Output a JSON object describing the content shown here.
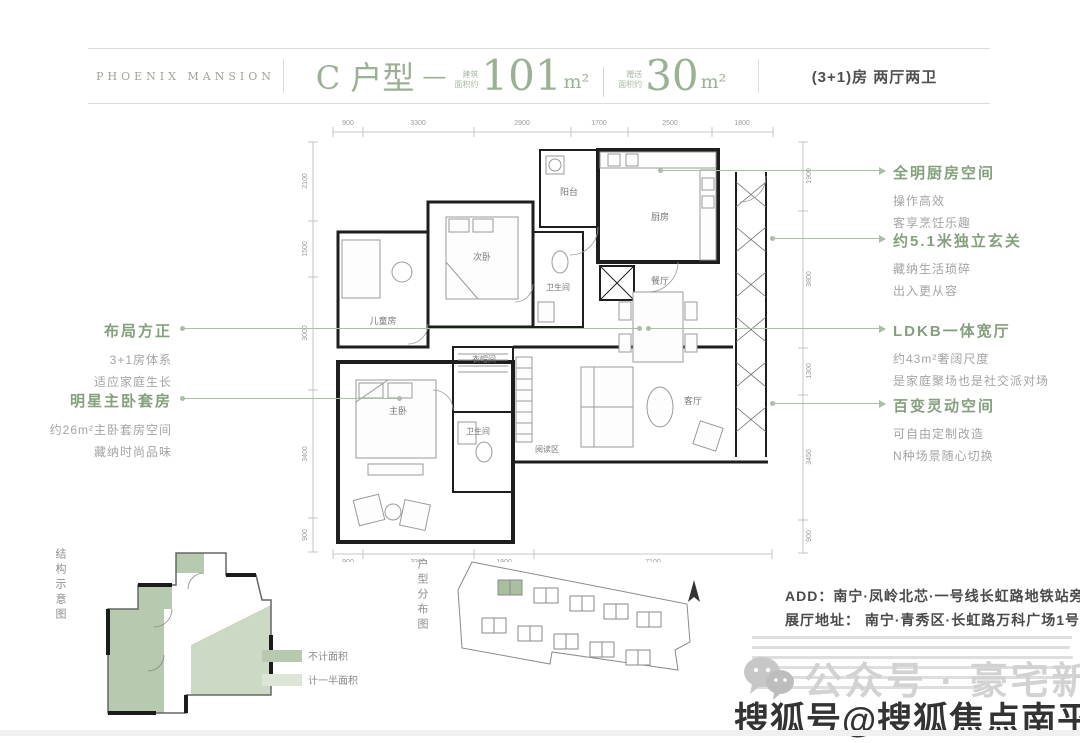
{
  "header": {
    "brand": "PHOENIX MANSION",
    "unit_name": "C 户型",
    "separator": "—",
    "areas": [
      {
        "label_line1": "建筑",
        "label_line2": "面积约",
        "value": "101",
        "unit": "m²"
      },
      {
        "label_line1": "赠送",
        "label_line2": "面积约",
        "value": "30",
        "unit": "m²"
      }
    ],
    "spec": "(3+1)房 两厅两卫"
  },
  "plan": {
    "dims_top": [
      "900",
      "3300",
      "2900",
      "1700",
      "2500",
      "1800"
    ],
    "dims_left": [
      "2100",
      "1500",
      "3000",
      "3400",
      "900"
    ],
    "dims_right": [
      "1900",
      "3800",
      "1300",
      "3450",
      "900"
    ],
    "dims_bottom": [
      "900",
      "3300",
      "1800",
      "7100"
    ],
    "rooms": {
      "balcony": "阳台",
      "kitchen": "厨房",
      "dining": "餐厅",
      "second_bedroom": "次卧",
      "bath1": "卫生间",
      "children": "儿童房",
      "master": "主卧",
      "cloakroom": "衣帽间",
      "bath2": "卫生间",
      "reading": "阅读区",
      "living": "客厅"
    }
  },
  "callouts_left": [
    {
      "title": "布局方正",
      "line1": "3+1房体系",
      "line2": "适应家庭生长"
    },
    {
      "title": "明星主卧套房",
      "line1": "约26m²主卧套房空间",
      "line2": "藏纳时尚品味"
    }
  ],
  "callouts_right": [
    {
      "title": "全明厨房空间",
      "line1": "操作高效",
      "line2": "客享烹饪乐趣"
    },
    {
      "title": "约5.1米独立玄关",
      "line1": "藏纳生活琐碎",
      "line2": "出入更从容"
    },
    {
      "title": "LDKB一体宽厅",
      "line1": "约43m²奢阔尺度",
      "line2": "是家庭聚场也是社交派对场"
    },
    {
      "title": "百变灵动空间",
      "line1": "可自由定制改造",
      "line2": "N种场景随心切换"
    }
  ],
  "footer": {
    "structure_label": "结构示意图",
    "legend": [
      {
        "label": "不计面积",
        "color": "#b7c9ae"
      },
      {
        "label": "计一半面积",
        "color": "#dde6d6"
      }
    ],
    "siteplan_label": "户型分布图",
    "address_line1": "ADD：南宁·凤岭北芯·一号线长虹路地铁站旁",
    "address_line2": "展厅地址： 南宁·青秀区·长虹路万科广场1号门"
  },
  "watermarks": {
    "wechat": "公众号 · 豪宅新讯",
    "sohu": "搜狐号@搜狐焦点南平站"
  },
  "colors": {
    "accent_green": "#9cb096",
    "callout_green": "#85a07e",
    "leader_green": "#aabfa5",
    "text_gray": "#a4a4a4",
    "dark_text": "#4a4a4a"
  }
}
